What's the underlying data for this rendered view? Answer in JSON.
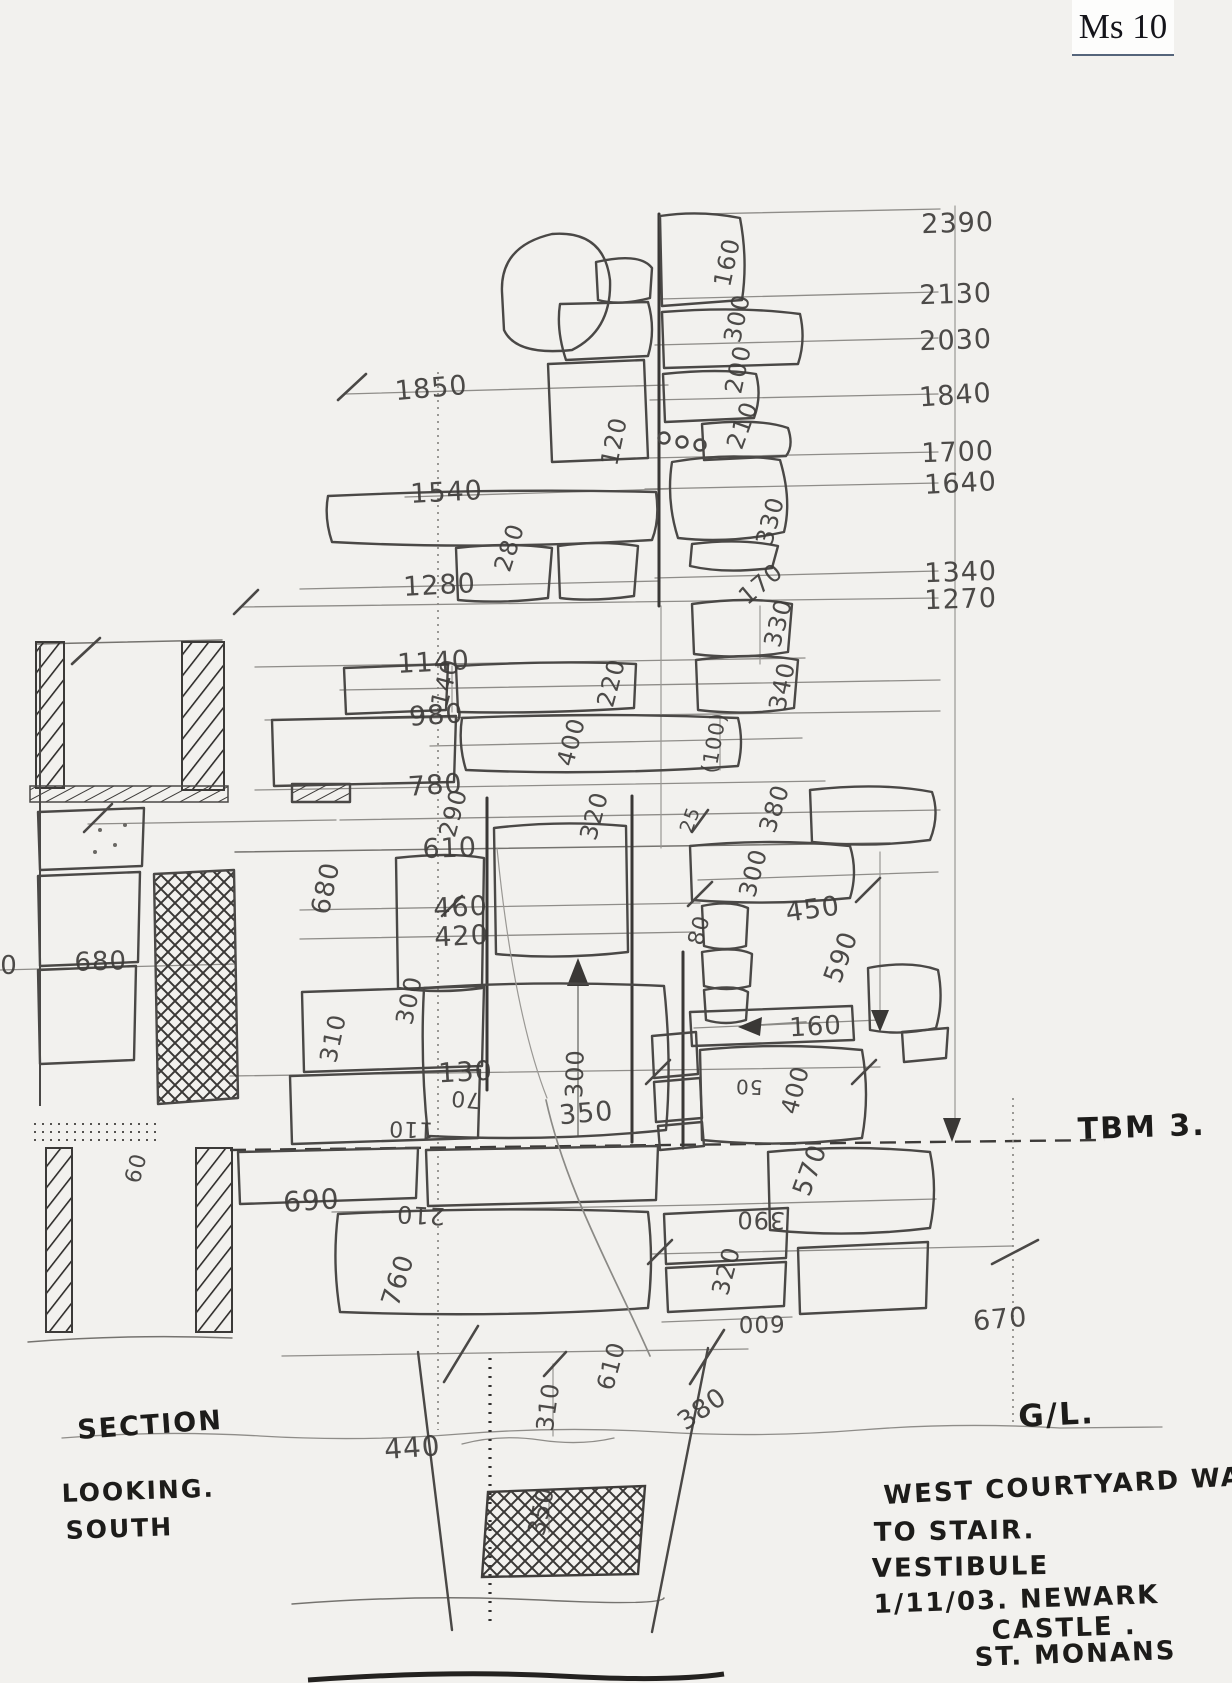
{
  "card": {
    "label": "Ms 10"
  },
  "labels": [
    {
      "n": "elevation-2390",
      "t": "2390",
      "x": 958,
      "y": 232,
      "r": -2,
      "s": 27
    },
    {
      "n": "elevation-2130",
      "t": "2130",
      "x": 956,
      "y": 303,
      "r": -2,
      "s": 27
    },
    {
      "n": "elevation-2030",
      "t": "2030",
      "x": 956,
      "y": 349,
      "r": -2,
      "s": 27
    },
    {
      "n": "elevation-1840",
      "t": "1840",
      "x": 956,
      "y": 404,
      "r": -4,
      "s": 27
    },
    {
      "n": "elevation-1700",
      "t": "1700",
      "x": 958,
      "y": 461,
      "r": -2,
      "s": 27
    },
    {
      "n": "elevation-1640",
      "t": "1640",
      "x": 961,
      "y": 492,
      "r": -3,
      "s": 27
    },
    {
      "n": "elevation-1340",
      "t": "1340",
      "x": 961,
      "y": 581,
      "r": -2,
      "s": 27
    },
    {
      "n": "elevation-1270",
      "t": "1270",
      "x": 961,
      "y": 608,
      "r": -2,
      "s": 27
    },
    {
      "n": "level-1850",
      "t": "1850",
      "x": 432,
      "y": 397,
      "r": -5,
      "s": 27
    },
    {
      "n": "level-1540",
      "t": "1540",
      "x": 447,
      "y": 501,
      "r": -3,
      "s": 27
    },
    {
      "n": "level-1280",
      "t": "1280",
      "x": 440,
      "y": 594,
      "r": -3,
      "s": 27
    },
    {
      "n": "level-1140",
      "t": "1140",
      "x": 434,
      "y": 671,
      "r": -3,
      "s": 27
    },
    {
      "n": "level-980",
      "t": "980",
      "x": 437,
      "y": 724,
      "r": -4,
      "s": 27
    },
    {
      "n": "level-780",
      "t": "780",
      "x": 436,
      "y": 794,
      "r": -4,
      "s": 27
    },
    {
      "n": "level-610",
      "t": "610",
      "x": 450,
      "y": 857,
      "r": -2,
      "s": 27
    },
    {
      "n": "level-460",
      "t": "460",
      "x": 461,
      "y": 916,
      "r": -3,
      "s": 27
    },
    {
      "n": "level-420",
      "t": "420",
      "x": 462,
      "y": 945,
      "r": -3,
      "s": 27
    },
    {
      "n": "level-130",
      "t": "130",
      "x": 466,
      "y": 1081,
      "r": -3,
      "s": 27
    },
    {
      "n": "dim-160-quoin",
      "t": "160",
      "x": 735,
      "y": 264,
      "r": -78
    },
    {
      "n": "dim-300-quoin",
      "t": "300",
      "x": 745,
      "y": 320,
      "r": -78
    },
    {
      "n": "dim-200-quoin",
      "t": "200",
      "x": 746,
      "y": 371,
      "r": -78
    },
    {
      "n": "dim-210-quoin",
      "t": "210",
      "x": 750,
      "y": 428,
      "r": -70
    },
    {
      "n": "dim-120",
      "t": "120",
      "x": 622,
      "y": 443,
      "r": -78
    },
    {
      "n": "dim-280",
      "t": "280",
      "x": 517,
      "y": 550,
      "r": -72
    },
    {
      "n": "dim-330-a",
      "t": "330",
      "x": 778,
      "y": 523,
      "r": -75
    },
    {
      "n": "dim-170",
      "t": "170",
      "x": 766,
      "y": 590,
      "r": -40
    },
    {
      "n": "dim-330-b",
      "t": "330",
      "x": 786,
      "y": 625,
      "r": -75
    },
    {
      "n": "dim-340",
      "t": "340",
      "x": 790,
      "y": 688,
      "r": -78
    },
    {
      "n": "dim-220",
      "t": "220",
      "x": 619,
      "y": 685,
      "r": -75
    },
    {
      "n": "dim-140",
      "t": "140",
      "x": 453,
      "y": 685,
      "r": -75
    },
    {
      "n": "dim-400-a",
      "t": "400",
      "x": 579,
      "y": 744,
      "r": -75
    },
    {
      "n": "dim-100-paren",
      "t": "(100)",
      "x": 721,
      "y": 744,
      "r": -80,
      "s": 21
    },
    {
      "n": "dim-290",
      "t": "290",
      "x": 461,
      "y": 815,
      "r": -75
    },
    {
      "n": "dim-320-a",
      "t": "320",
      "x": 602,
      "y": 818,
      "r": -75
    },
    {
      "n": "dim-25",
      "t": "25",
      "x": 696,
      "y": 822,
      "r": -70,
      "s": 19
    },
    {
      "n": "dim-380-a",
      "t": "380",
      "x": 782,
      "y": 811,
      "r": -72
    },
    {
      "n": "dim-680-a",
      "t": "680",
      "x": 334,
      "y": 890,
      "r": -78,
      "s": 26
    },
    {
      "n": "dim-300-b",
      "t": "300",
      "x": 761,
      "y": 875,
      "r": -75
    },
    {
      "n": "dim-450",
      "t": "450",
      "x": 814,
      "y": 918,
      "r": -8,
      "s": 27
    },
    {
      "n": "dim-80",
      "t": "80",
      "x": 706,
      "y": 932,
      "r": -75,
      "s": 22
    },
    {
      "n": "dim-590",
      "t": "590",
      "x": 849,
      "y": 960,
      "r": -70,
      "s": 26
    },
    {
      "n": "dim-300-c",
      "t": "300",
      "x": 417,
      "y": 1002,
      "r": -78
    },
    {
      "n": "dim-310-a",
      "t": "310",
      "x": 341,
      "y": 1040,
      "r": -78
    },
    {
      "n": "dim-300-arrow",
      "t": "300",
      "x": 583,
      "y": 1074,
      "r": -88
    },
    {
      "n": "dim-350-a",
      "t": "350",
      "x": 587,
      "y": 1122,
      "r": -5,
      "s": 27
    },
    {
      "n": "dim-70",
      "t": "70",
      "x": 466,
      "y": 1092,
      "r": 185,
      "s": 22
    },
    {
      "n": "dim-110",
      "t": "110",
      "x": 411,
      "y": 1122,
      "r": 182,
      "s": 22
    },
    {
      "n": "dim-50",
      "t": "50",
      "x": 749,
      "y": 1080,
      "r": 182,
      "s": 20
    },
    {
      "n": "dim-160-b",
      "t": "160",
      "x": 816,
      "y": 1035,
      "r": -3,
      "s": 26
    },
    {
      "n": "dim-400-b",
      "t": "400",
      "x": 803,
      "y": 1092,
      "r": -75
    },
    {
      "n": "dim-570",
      "t": "570",
      "x": 818,
      "y": 1173,
      "r": -70,
      "s": 26
    },
    {
      "n": "dim-690",
      "t": "690",
      "x": 312,
      "y": 1210,
      "r": -4,
      "s": 28
    },
    {
      "n": "dim-210-b",
      "t": "210",
      "x": 421,
      "y": 1207,
      "r": 183
    },
    {
      "n": "dim-390",
      "t": "390",
      "x": 761,
      "y": 1212,
      "r": 181
    },
    {
      "n": "dim-670",
      "t": "670",
      "x": 1001,
      "y": 1328,
      "r": -5,
      "s": 27
    },
    {
      "n": "dim-760",
      "t": "760",
      "x": 406,
      "y": 1283,
      "r": -72,
      "s": 26
    },
    {
      "n": "dim-320-b",
      "t": "320",
      "x": 734,
      "y": 1273,
      "r": -75
    },
    {
      "n": "dim-600",
      "t": "600",
      "x": 761,
      "y": 1316,
      "r": 179,
      "s": 23
    },
    {
      "n": "dim-610-b",
      "t": "610",
      "x": 619,
      "y": 1368,
      "r": -75
    },
    {
      "n": "dim-310-b",
      "t": "310",
      "x": 556,
      "y": 1408,
      "r": -82
    },
    {
      "n": "dim-380-b",
      "t": "380",
      "x": 707,
      "y": 1416,
      "r": -35,
      "s": 26
    },
    {
      "n": "dim-440",
      "t": "440",
      "x": 413,
      "y": 1457,
      "r": -4,
      "s": 28
    },
    {
      "n": "dim-350-b",
      "t": "350",
      "x": 549,
      "y": 1513,
      "r": -78
    },
    {
      "n": "dim-60",
      "t": "60",
      "x": 143,
      "y": 1170,
      "r": -75,
      "s": 22
    },
    {
      "n": "dim-680-section",
      "t": "680",
      "x": 101,
      "y": 970,
      "r": -2,
      "s": 26
    },
    {
      "n": "dim-0-section",
      "t": "0",
      "x": 9,
      "y": 974,
      "r": 0,
      "s": 26
    },
    {
      "n": "note-tbm",
      "t": "TBM 3.",
      "x": 1142,
      "y": 1137,
      "r": -2,
      "s": 30,
      "k": "i"
    },
    {
      "n": "note-ground-level",
      "t": "G/L.",
      "x": 1057,
      "y": 1425,
      "r": -3,
      "s": 31,
      "k": "i"
    },
    {
      "n": "note-section",
      "t": "SECTION",
      "x": 78,
      "y": 1439,
      "r": -4,
      "s": 27,
      "k": "i",
      "a": "start"
    },
    {
      "n": "note-looking",
      "t": "LOOKING.",
      "x": 62,
      "y": 1502,
      "r": -2,
      "s": 25,
      "k": "i",
      "a": "start"
    },
    {
      "n": "note-south",
      "t": "SOUTH",
      "x": 66,
      "y": 1539,
      "r": -2,
      "s": 25,
      "k": "i",
      "a": "start"
    },
    {
      "n": "title-line-1",
      "t": "WEST  COURTYARD  WALL",
      "x": 884,
      "y": 1504,
      "r": -3,
      "s": 26,
      "k": "i",
      "a": "start"
    },
    {
      "n": "title-line-2",
      "t": "TO  STAIR.",
      "x": 874,
      "y": 1541,
      "r": -1,
      "s": 26,
      "k": "i",
      "a": "start"
    },
    {
      "n": "title-line-3",
      "t": "VESTIBULE",
      "x": 872,
      "y": 1577,
      "r": -1,
      "s": 26,
      "k": "i",
      "a": "start"
    },
    {
      "n": "title-line-4",
      "t": "1/11/03.   NEWARK",
      "x": 874,
      "y": 1613,
      "r": -2,
      "s": 26,
      "k": "i",
      "a": "start"
    },
    {
      "n": "title-line-5",
      "t": "CASTLE .",
      "x": 992,
      "y": 1639,
      "r": -2,
      "s": 26,
      "k": "i",
      "a": "start"
    },
    {
      "n": "title-line-6",
      "t": "ST.  MONANS",
      "x": 975,
      "y": 1666,
      "r": -2,
      "s": 26,
      "k": "i",
      "a": "start"
    }
  ]
}
